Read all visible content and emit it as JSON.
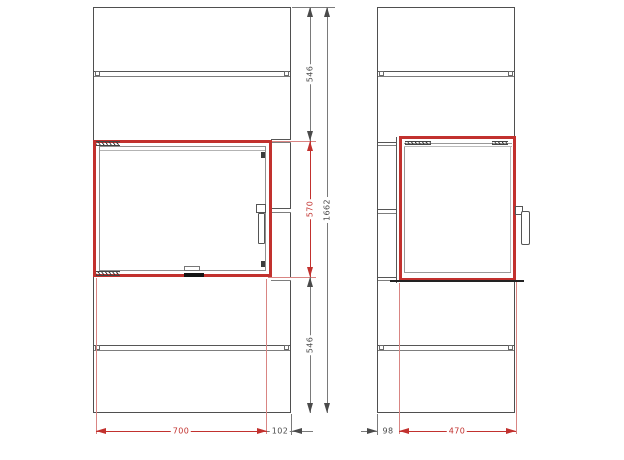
{
  "drawing": {
    "kind": "technical-drawing",
    "subject": "stove front and side elevation with door dimensions",
    "colors": {
      "outline_gray": "#4f4f4f",
      "dim_gray": "#7a7a7a",
      "highlight_red": "#c2312e",
      "extension_red": "#d98583"
    },
    "front_view": {
      "dimensions": {
        "upper_section_height": "546",
        "door_height": "570",
        "lower_section_height": "546",
        "total_height": "1662",
        "door_width": "700",
        "right_panel_width": "102"
      }
    },
    "side_view": {
      "dimensions": {
        "rear_body_depth": "98",
        "door_depth": "470"
      }
    }
  }
}
